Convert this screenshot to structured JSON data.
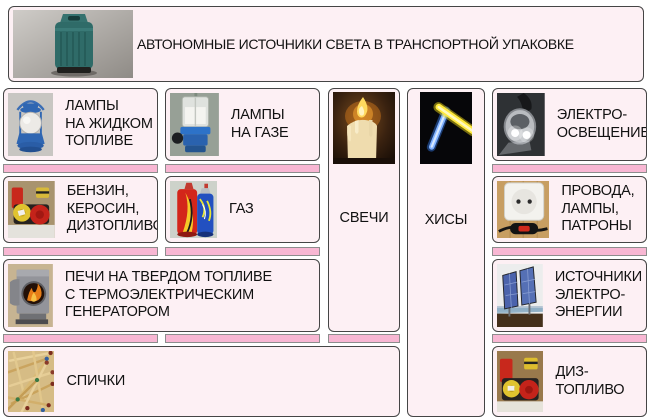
{
  "header": {
    "title": "АВТОНОМНЫЕ ИСТОЧНИКИ СВЕТА В ТРАНСПОРТНОЙ УПАКОВКЕ",
    "image": "transport-case-photo"
  },
  "boxes": {
    "liquid_lamps": {
      "label": "ЛАМПЫ\nНА ЖИДКОМ\nТОПЛИВЕ",
      "image": "kerosene-lantern-photo"
    },
    "gas_lamps": {
      "label": "ЛАМПЫ\nНА ГАЗЕ",
      "image": "gas-lamp-photo"
    },
    "candles": {
      "label": "СВЕЧИ",
      "image": "burning-candle-photo"
    },
    "glow_sticks": {
      "label": "ХИСЫ",
      "image": "glow-sticks-photo"
    },
    "electric_light": {
      "label": "ЭЛЕКТРО-\nОСВЕЩЕНИЕ",
      "image": "led-flashlight-photo"
    },
    "liquid_fuel": {
      "label": "БЕНЗИН,\nКЕРОСИН,\nДИЗТОПЛИВО",
      "image": "fuel-barrels-photo"
    },
    "gas_fuel": {
      "label": "ГАЗ",
      "image": "gas-canisters-photo"
    },
    "wiring": {
      "label": "ПРОВОДА,\nЛАМПЫ,\nПАТРОНЫ",
      "image": "socket-switch-photo"
    },
    "stoves": {
      "label": "ПЕЧИ НА ТВЕРДОМ ТОПЛИВЕ\nС ТЕРМОЭЛЕКТРИЧЕСКИМ\nГЕНЕРАТОРОМ",
      "image": "solid-fuel-stove-photo"
    },
    "power_sources": {
      "label": "ИСТОЧНИКИ\nЭЛЕКТРО-\nЭНЕРГИИ",
      "image": "solar-panels-photo"
    },
    "matches": {
      "label": "СПИЧКИ",
      "image": "matches-photo"
    },
    "diesel": {
      "label": "ДИЗ-\nТОПЛИВО",
      "image": "diesel-barrels-photo"
    }
  },
  "colors": {
    "box_background": "#fdf0f4",
    "connector_pink": "#f8b7d3",
    "border": "#454545",
    "text": "#111111"
  }
}
